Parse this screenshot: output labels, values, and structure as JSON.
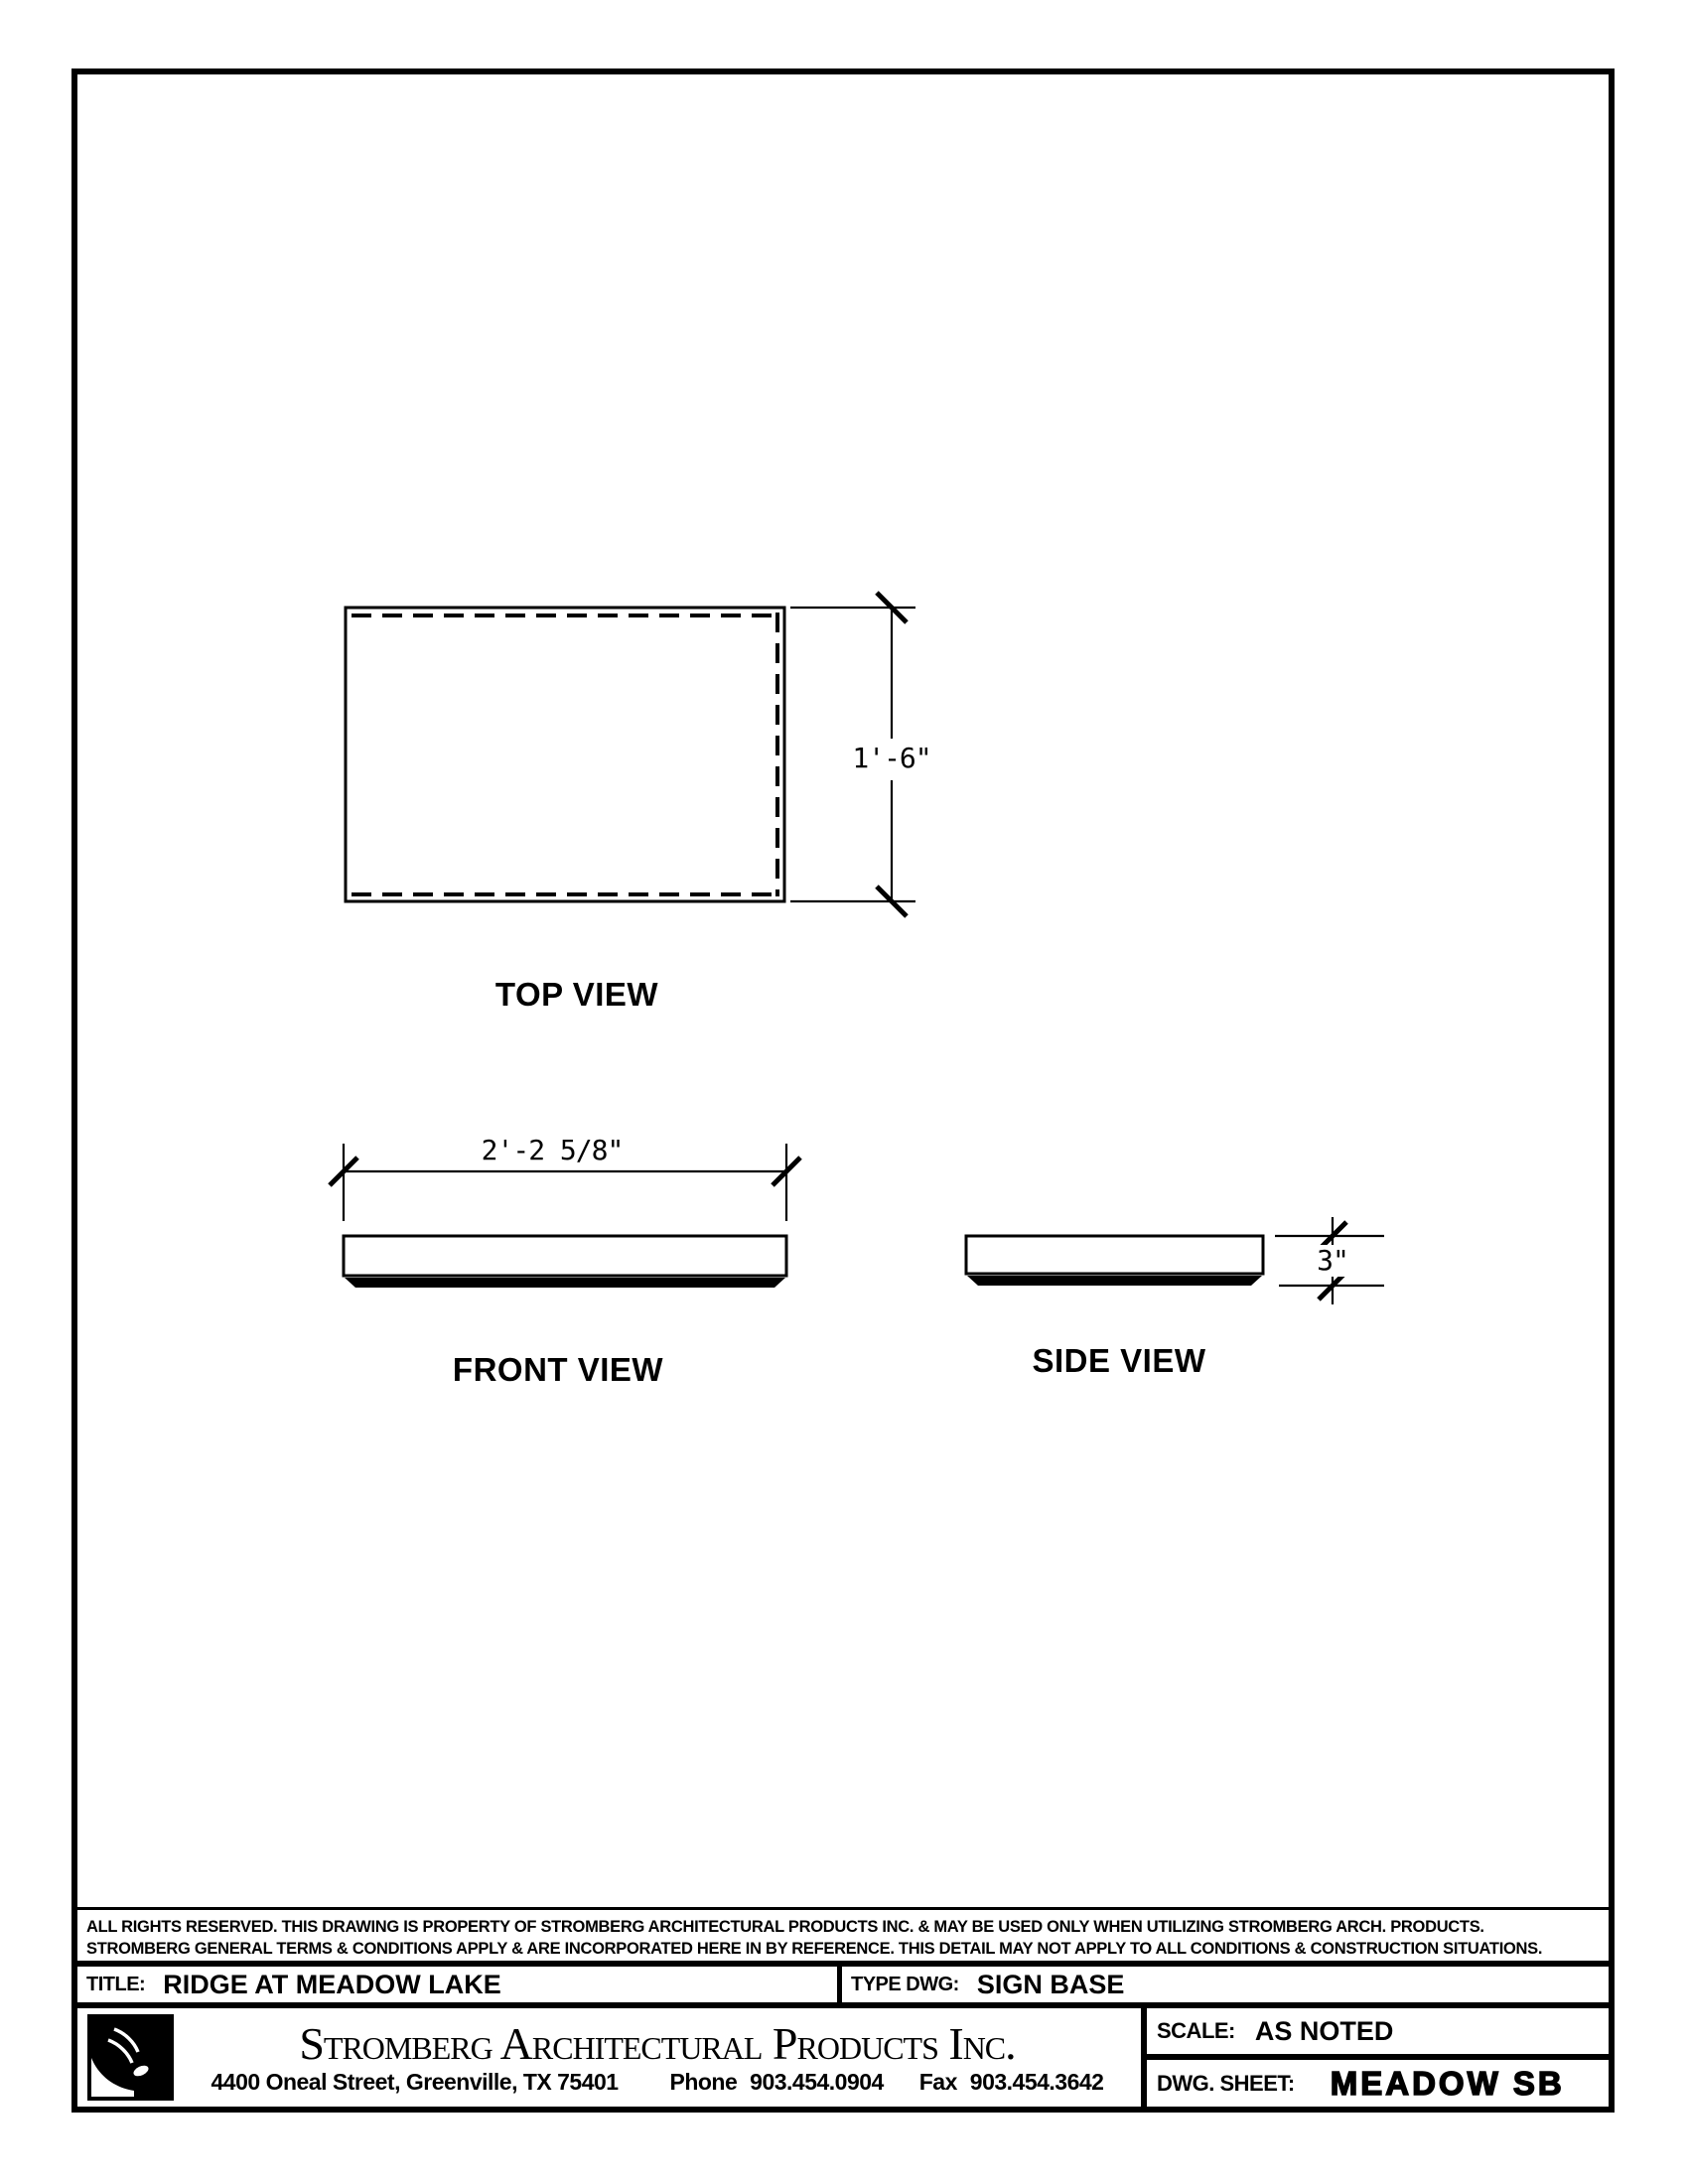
{
  "drawing": {
    "views": {
      "top": {
        "label": "TOP VIEW",
        "dim_height": "1'-6\""
      },
      "front": {
        "label": "FRONT VIEW",
        "dim_width": "2'-2 5/8\""
      },
      "side": {
        "label": "SIDE VIEW",
        "dim_thickness": "3\""
      }
    }
  },
  "legal": {
    "line1": "ALL RIGHTS RESERVED. THIS DRAWING IS PROPERTY OF STROMBERG ARCHITECTURAL PRODUCTS INC. & MAY BE USED ONLY WHEN UTILIZING STROMBERG ARCH. PRODUCTS.",
    "line2": "STROMBERG GENERAL TERMS & CONDITIONS APPLY & ARE INCORPORATED HERE IN BY REFERENCE. THIS DETAIL MAY NOT APPLY TO ALL CONDITIONS & CONSTRUCTION SITUATIONS."
  },
  "title_block": {
    "title_label": "TITLE:",
    "title_value": "RIDGE AT MEADOW LAKE",
    "type_label": "TYPE DWG:",
    "type_value": "SIGN BASE",
    "company_name": "Stromberg Architectural Products Inc.",
    "address": "4400 Oneal Street, Greenville, TX  75401",
    "phone_label": "Phone",
    "phone_number": "903.454.0904",
    "fax_label": "Fax",
    "fax_number": "903.454.3642",
    "scale_label": "SCALE:",
    "scale_value": "AS NOTED",
    "sheet_label": "DWG. SHEET:",
    "sheet_value": "MEADOW SB",
    "ink_color": "#000000",
    "paper_color": "#ffffff"
  }
}
